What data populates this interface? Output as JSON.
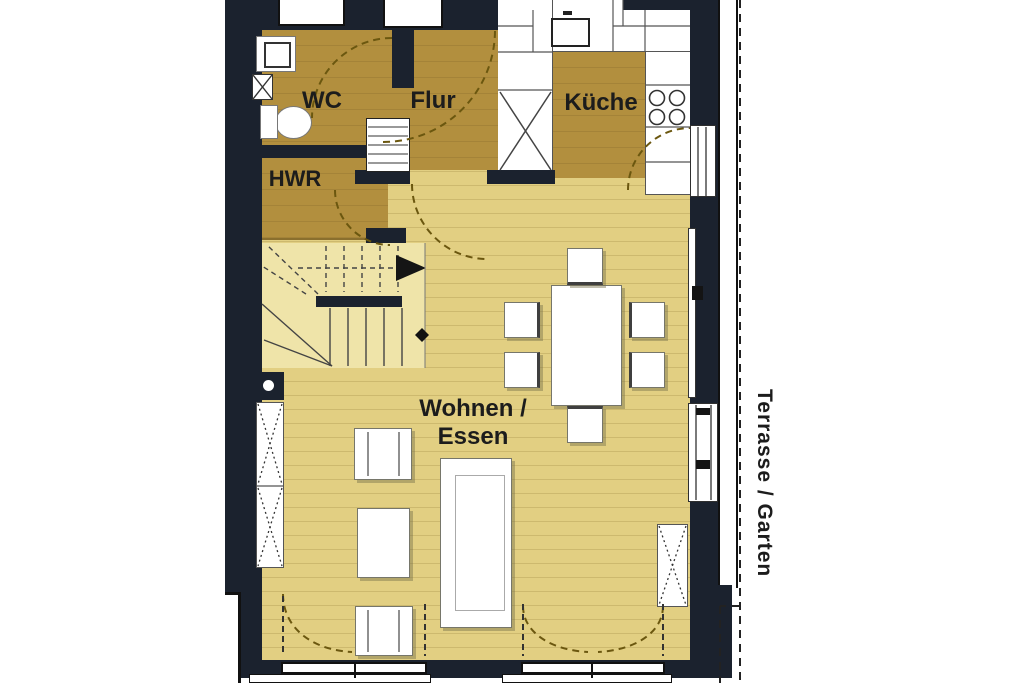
{
  "labels": {
    "wc": "WC",
    "flur": "Flur",
    "kueche": "Küche",
    "hwr": "HWR",
    "wohnen_line1": "Wohnen /",
    "wohnen_line2": "Essen",
    "terrasse": "Terrasse / Garten"
  },
  "colors": {
    "wall": "#1b222e",
    "floor_dark": "#b28f3e",
    "floor_light": "#e2cf82",
    "floor_stairs": "#efe4a9",
    "arc": "#6b570f",
    "outline": "#333333",
    "background": "#ffffff"
  },
  "fixtures": [
    "wc-sink",
    "toilet",
    "radiator",
    "wardrobe-shelf",
    "kitchen-sink",
    "stove-burners",
    "kitchen-tall-cabinet",
    "dining-table",
    "dining-chairs",
    "armchairs",
    "side-table",
    "sofa",
    "wall-cabinet",
    "terrace-door",
    "windows",
    "stairs-up-arrow"
  ]
}
